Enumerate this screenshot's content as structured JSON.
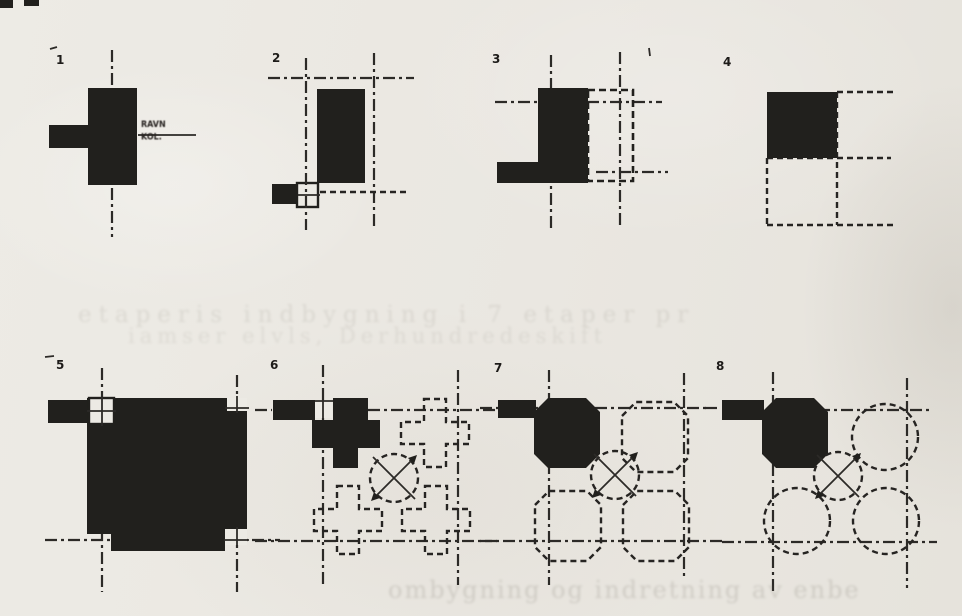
{
  "page": {
    "paper_color": "#eae7e1",
    "ink_color": "#21201d"
  },
  "figures": [
    {
      "number": "1",
      "annotation": {
        "line1": "RAVN",
        "line2": "KOL."
      }
    },
    {
      "number": "2"
    },
    {
      "number": "3"
    },
    {
      "number": "4"
    },
    {
      "number": "5"
    },
    {
      "number": "6"
    },
    {
      "number": "7"
    },
    {
      "number": "8"
    }
  ],
  "ghost_text": {
    "line1": "etaperis indbygning i 7 etaper pr",
    "line2": "iamser elvls, Derhundredeskift",
    "bottom": "ombygning og indretning av enbe"
  }
}
